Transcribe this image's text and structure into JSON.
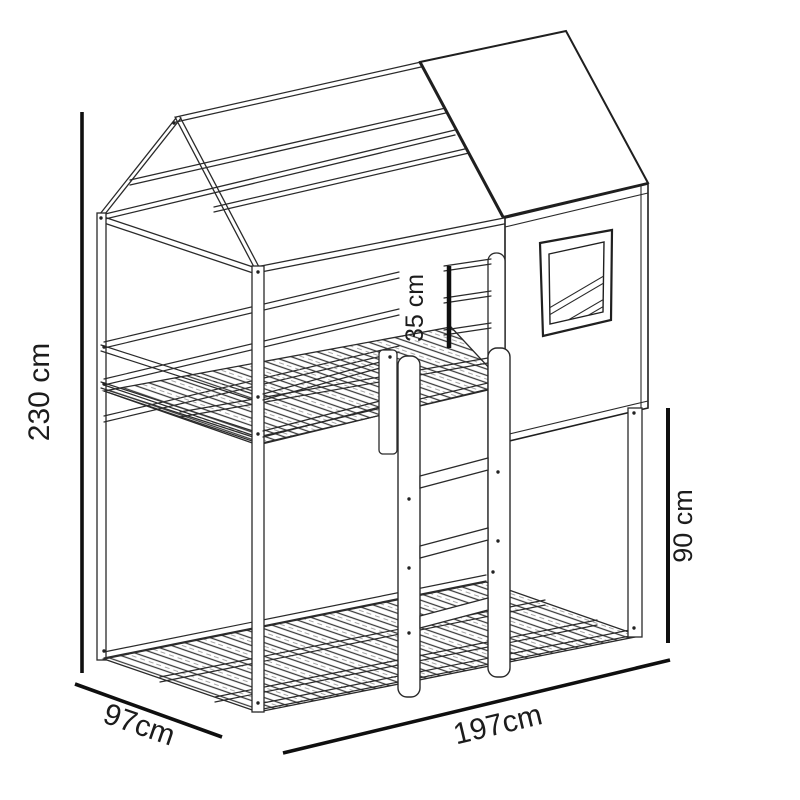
{
  "title": "House bunk bed technical drawing",
  "dimensions": {
    "total_height": "230 cm",
    "guard_rail_height": "35 cm",
    "under_clearance": "90 cm",
    "depth": "97cm",
    "length": "197cm"
  },
  "colors": {
    "line": "#2a2a2a",
    "dimension_line": "#0f0f0f",
    "background": "#ffffff"
  }
}
